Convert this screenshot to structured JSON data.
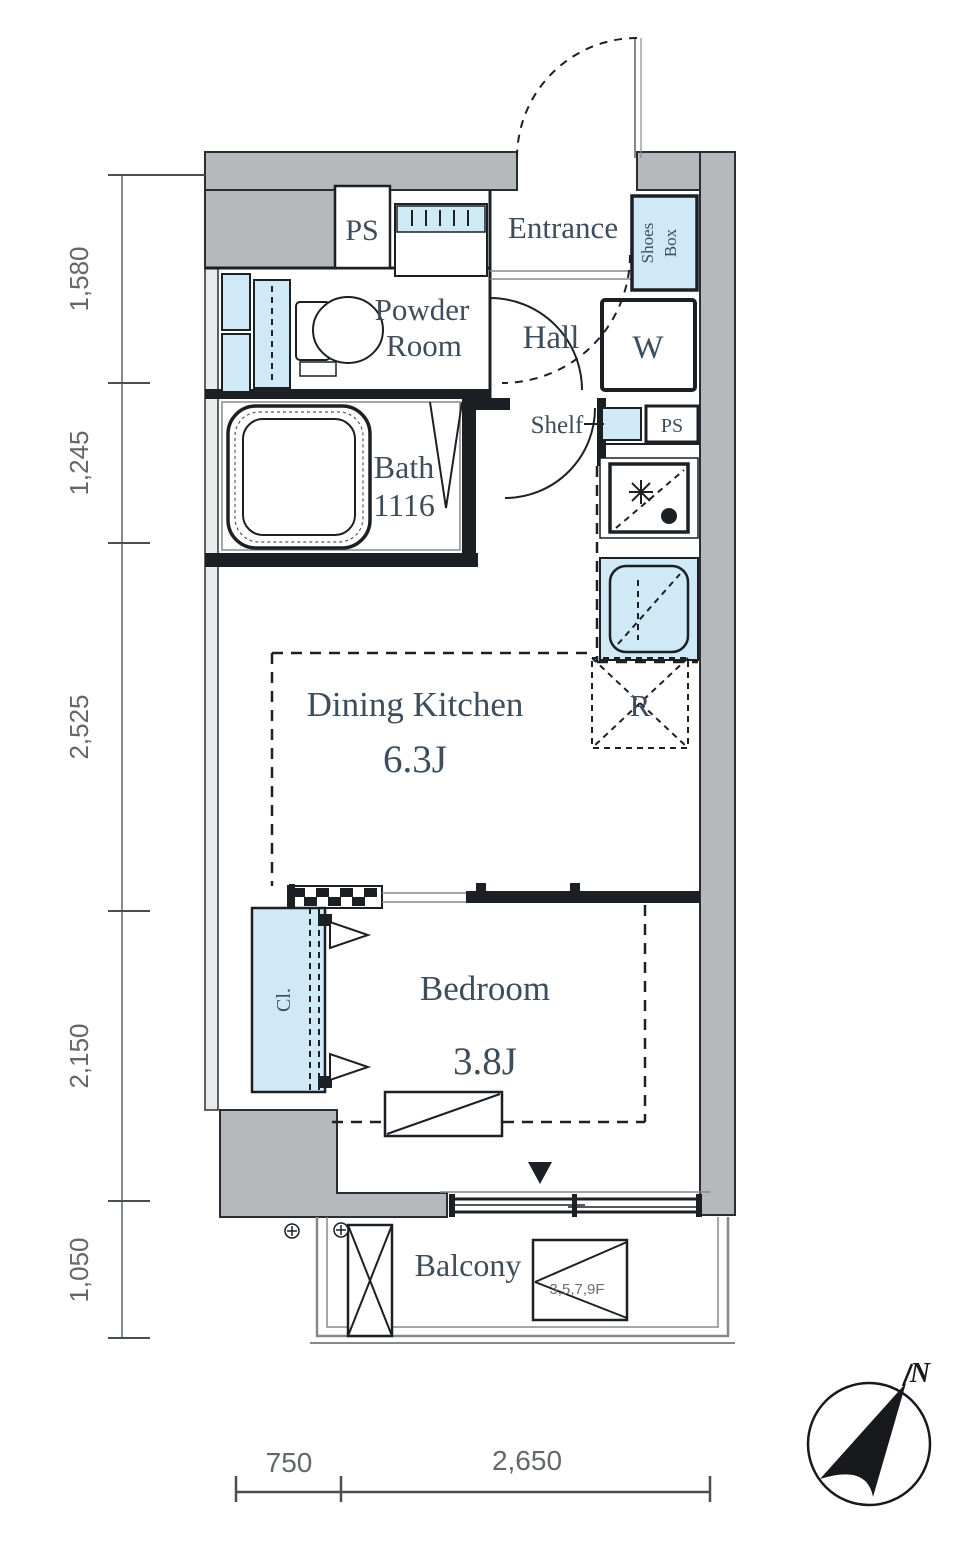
{
  "floorplan": {
    "rooms": {
      "ps_top": "PS",
      "entrance": "Entrance",
      "shoes_box_line1": "Shoes",
      "shoes_box_line2": "Box",
      "powder_room_line1": "Powder",
      "powder_room_line2": "Room",
      "hall": "Hall",
      "washer": "W",
      "shelf": "Shelf",
      "ps_side": "PS",
      "bath_line1": "Bath",
      "bath_line2": "1116",
      "dining_kitchen": "Dining Kitchen",
      "dining_kitchen_size": "6.3J",
      "fridge": "R",
      "bedroom": "Bedroom",
      "bedroom_size": "3.8J",
      "closet": "Cl.",
      "balcony": "Balcony"
    },
    "annotations": {
      "floor_levels": "3,5,7,9F",
      "north": "N"
    },
    "dimensions": {
      "left": [
        "1,580",
        "1,245",
        "2,525",
        "2,150",
        "1,050"
      ],
      "bottom": [
        "750",
        "2,650"
      ]
    },
    "colors": {
      "wall": "#b5b9bc",
      "fixture": "#cfe9f6",
      "line": "#1c2024",
      "text": "#3e4d5b",
      "dim": "#63676b"
    }
  }
}
